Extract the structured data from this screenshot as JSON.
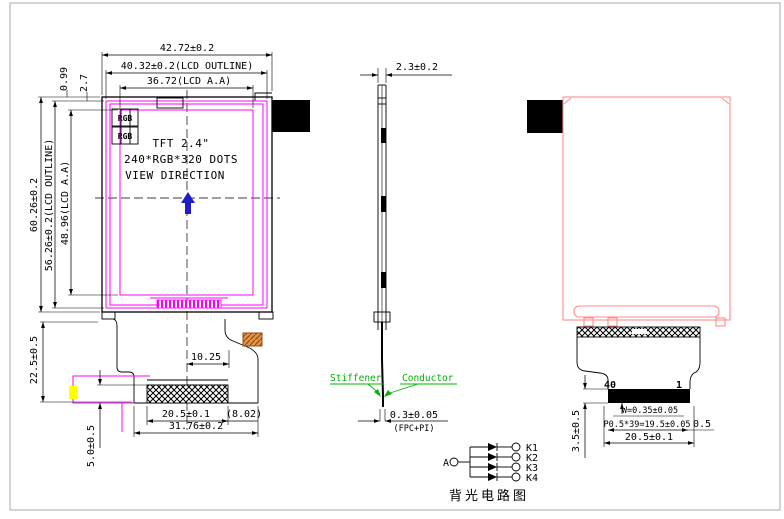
{
  "front": {
    "dim_w_total": "42.72±0.2",
    "dim_w_outline": "40.32±0.2(LCD OUTLINE)",
    "dim_w_aa": "36.72(LCD A.A)",
    "dim_h_total": "60.26±0.2",
    "dim_h_outline": "56.26±0.2(LCD OUTLINE)",
    "dim_h_aa": "48.96(LCD A.A)",
    "dim_offset_top1": "0.99",
    "dim_offset_top2": "2.7",
    "rgb_label": "RGB",
    "title_line1": "TFT 2.4\"",
    "title_line2": "240*RGB*320 DOTS",
    "title_line3": "VIEW DIRECTION",
    "dim_fpc_offset": "10.25",
    "dim_contact_width": "20.5±0.1",
    "dim_ref": "(8.02)",
    "dim_fpc_width": "31.76±0.2",
    "dim_tail_len": "22.5±0.5",
    "dim_tape_len": "5.0±0.5"
  },
  "side": {
    "dim_thickness": "2.3±0.2",
    "stiffener_label": "Stiffener",
    "conductor_label": "Conductor",
    "dim_fpc_thickness": "0.3±0.05",
    "fpc_note": "(FPC+PI)"
  },
  "back": {
    "pin40": "40",
    "pin1": "1",
    "dim_pad_width": "W=0.35±0.05",
    "dim_pitch": "P0.5*39=19.5±0.05",
    "dim_edge_gap": "0.5",
    "dim_contact_width": "20.5±0.1",
    "dim_pin_length": "3.5±0.5"
  },
  "circuit": {
    "anode_label": "A",
    "cathode_labels": [
      "K1",
      "K2",
      "K3",
      "K4"
    ],
    "caption": "背光电路图"
  },
  "colors": {
    "line": "#000000",
    "magenta": "#ff00ff",
    "back_outline_pink": "#ff8c8c",
    "view_arrow_blue": "#1f1fc8",
    "annotation_green": "#00b400",
    "component_orange": "#e8954a",
    "tape_yellow": "#ffff00",
    "frame_gray": "#b8b8b8"
  }
}
